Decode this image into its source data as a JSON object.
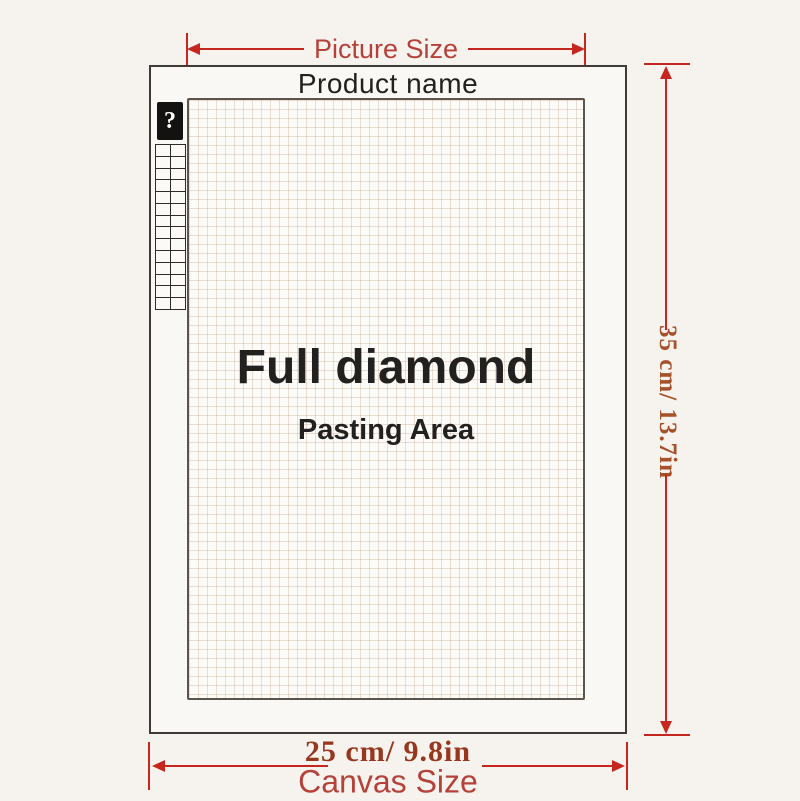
{
  "colors": {
    "page_bg": "#f6f3ef",
    "dimension_line": "#c5271e",
    "size_label_red": "#b5423a",
    "measurement_rust_v": "#a5512a",
    "measurement_rust_h": "#97371d",
    "text_black": "#23211f"
  },
  "canvas": {
    "product_name": "Product name"
  },
  "pasting_area": {
    "title": "Full diamond",
    "subtitle": "Pasting Area"
  },
  "legend": {
    "header_symbol": "?",
    "rows": 14,
    "columns": 2
  },
  "dimensions": {
    "picture_width": {
      "label": "Picture Size"
    },
    "canvas_height": {
      "value": "35 cm/ 13.7in"
    },
    "canvas_width": {
      "value": "25 cm/ 9.8in",
      "label": "Canvas Size"
    }
  }
}
